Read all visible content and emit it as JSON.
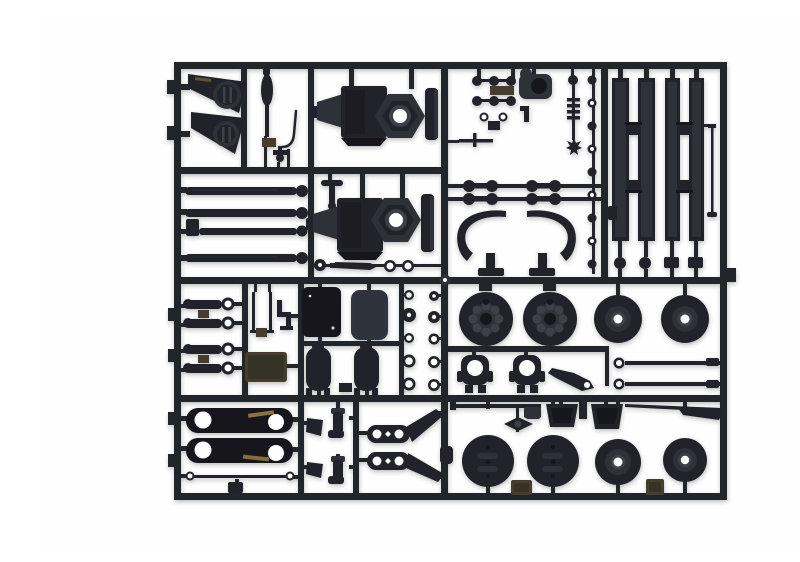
{
  "meta": {
    "title": "Black plastic model-kit sprue with truck chassis parts",
    "description": "Photograph of a rectangular injection-molded polystyrene sprue (runner frame) holding unpainted black truck-chassis model parts, shot on a plain white background."
  },
  "colors": {
    "background": "#ffffff",
    "runner": "#24272c",
    "plastic": "#202329",
    "plastic_dark": "#15171b",
    "plastic_mid": "#2d3138",
    "plastic_light": "#3c414a",
    "steel": "#2e353d",
    "bronze": "#473e2d",
    "bronze_bright": "#a08347",
    "hole": "#fefefe"
  },
  "sprue": {
    "material": "black styrene",
    "frame_shape": "rectangle with internal cross runners and edge tabs",
    "sections": {
      "top_left": [
        "fender-flap x2",
        "hub-cap x2",
        "gear-lever",
        "brake-pipe",
        "valve-fitting"
      ],
      "driveshafts": [
        "drive-shaft with ball end x4",
        "tee-fitting",
        "grommet",
        "cone-pin",
        "o-ring x2"
      ],
      "differentials": [
        "axle-housing with hex cover x2"
      ],
      "fittings_cluster": [
        "knob x6",
        "washer x2",
        "air-filter",
        "spring-stack",
        "star-gear",
        "tee-rod",
        "knob-column x9",
        "dumbbell-link x4",
        "cab-deflector x2"
      ],
      "chassis_rails": [
        "frame-rail x4",
        "cross-member x4",
        "antenna-rod",
        "clip",
        "end-knob x2",
        "end-block x2"
      ],
      "link_rods": [
        "eye-end link rod x4",
        "bronze-block x2"
      ],
      "tanks_plates": [
        "u-pipe",
        "step-bracket",
        "dark-plate",
        "steel-plate",
        "bronze-plate",
        "air-tank x2"
      ],
      "washers": [
        "washer-ring x10"
      ],
      "mid_wheels": [
        "brake-drum wheel x2",
        "hub-disc wheel x2",
        "steering-knuckle x2",
        "lever-bracket",
        "tie-rod x2"
      ],
      "leaf_links": [
        "leaf-spring link x2",
        "thin tie rod",
        "mount-block"
      ],
      "elbows": [
        "wedge-clip x2",
        "elbow-fitting x2"
      ],
      "steering_arms": [
        "pitman-arm x2",
        "small-housing"
      ],
      "bottom_wheels": [
        "slotted wheel x2",
        "hub-disc wheel x2",
        "mud-bucket x2",
        "axle-rod",
        "tapered-rod",
        "bowtie-link",
        "bronze-block x2"
      ]
    },
    "counts": {
      "wheels_total": 8,
      "frame_rails": 4,
      "axle_housings": 2
    }
  }
}
